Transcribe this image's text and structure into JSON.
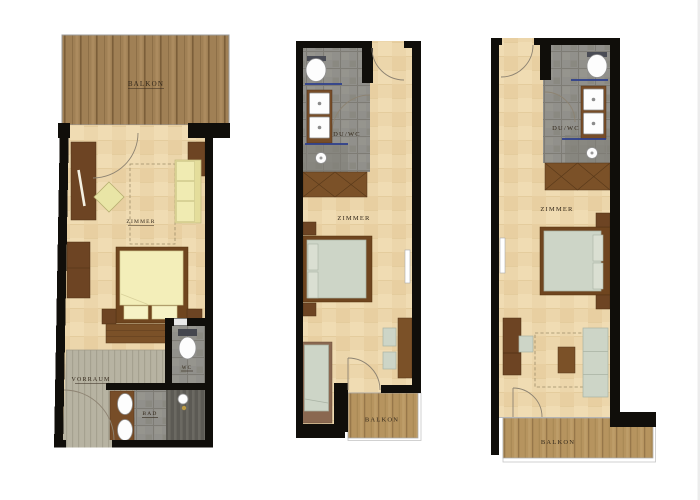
{
  "title": "Hotel room floor plans",
  "palette": {
    "wall": "#100e0a",
    "floor": "#ecd6ab",
    "balcony_wood_dark": "#a08055",
    "balcony_wood_light": "#b6945f",
    "tile_gray": "#91908b",
    "vorraum_floor": "#b7b3a2",
    "furniture_brown": "#7b5128",
    "bed_yellow": "#f3eeb9",
    "sofa_yellow": "#f0ebb2",
    "upholstery_sage": "#cdd5c7",
    "glass_blue": "#2c3e8c",
    "label": "#32271a",
    "outline": "#9b9b9b"
  },
  "plans": [
    {
      "id": "apartment",
      "labels": {
        "balcony": "BALKON",
        "room": "ZIMMER",
        "hall": "VORRAUM",
        "wc": "WC",
        "bath": "BAD"
      }
    },
    {
      "id": "room-a",
      "labels": {
        "shower_wc": "DU/WC",
        "room": "ZIMMER",
        "balcony": "BALKON"
      }
    },
    {
      "id": "room-b",
      "labels": {
        "shower_wc": "DU/WC",
        "room": "ZIMMER",
        "balcony": "BALKON"
      }
    }
  ]
}
